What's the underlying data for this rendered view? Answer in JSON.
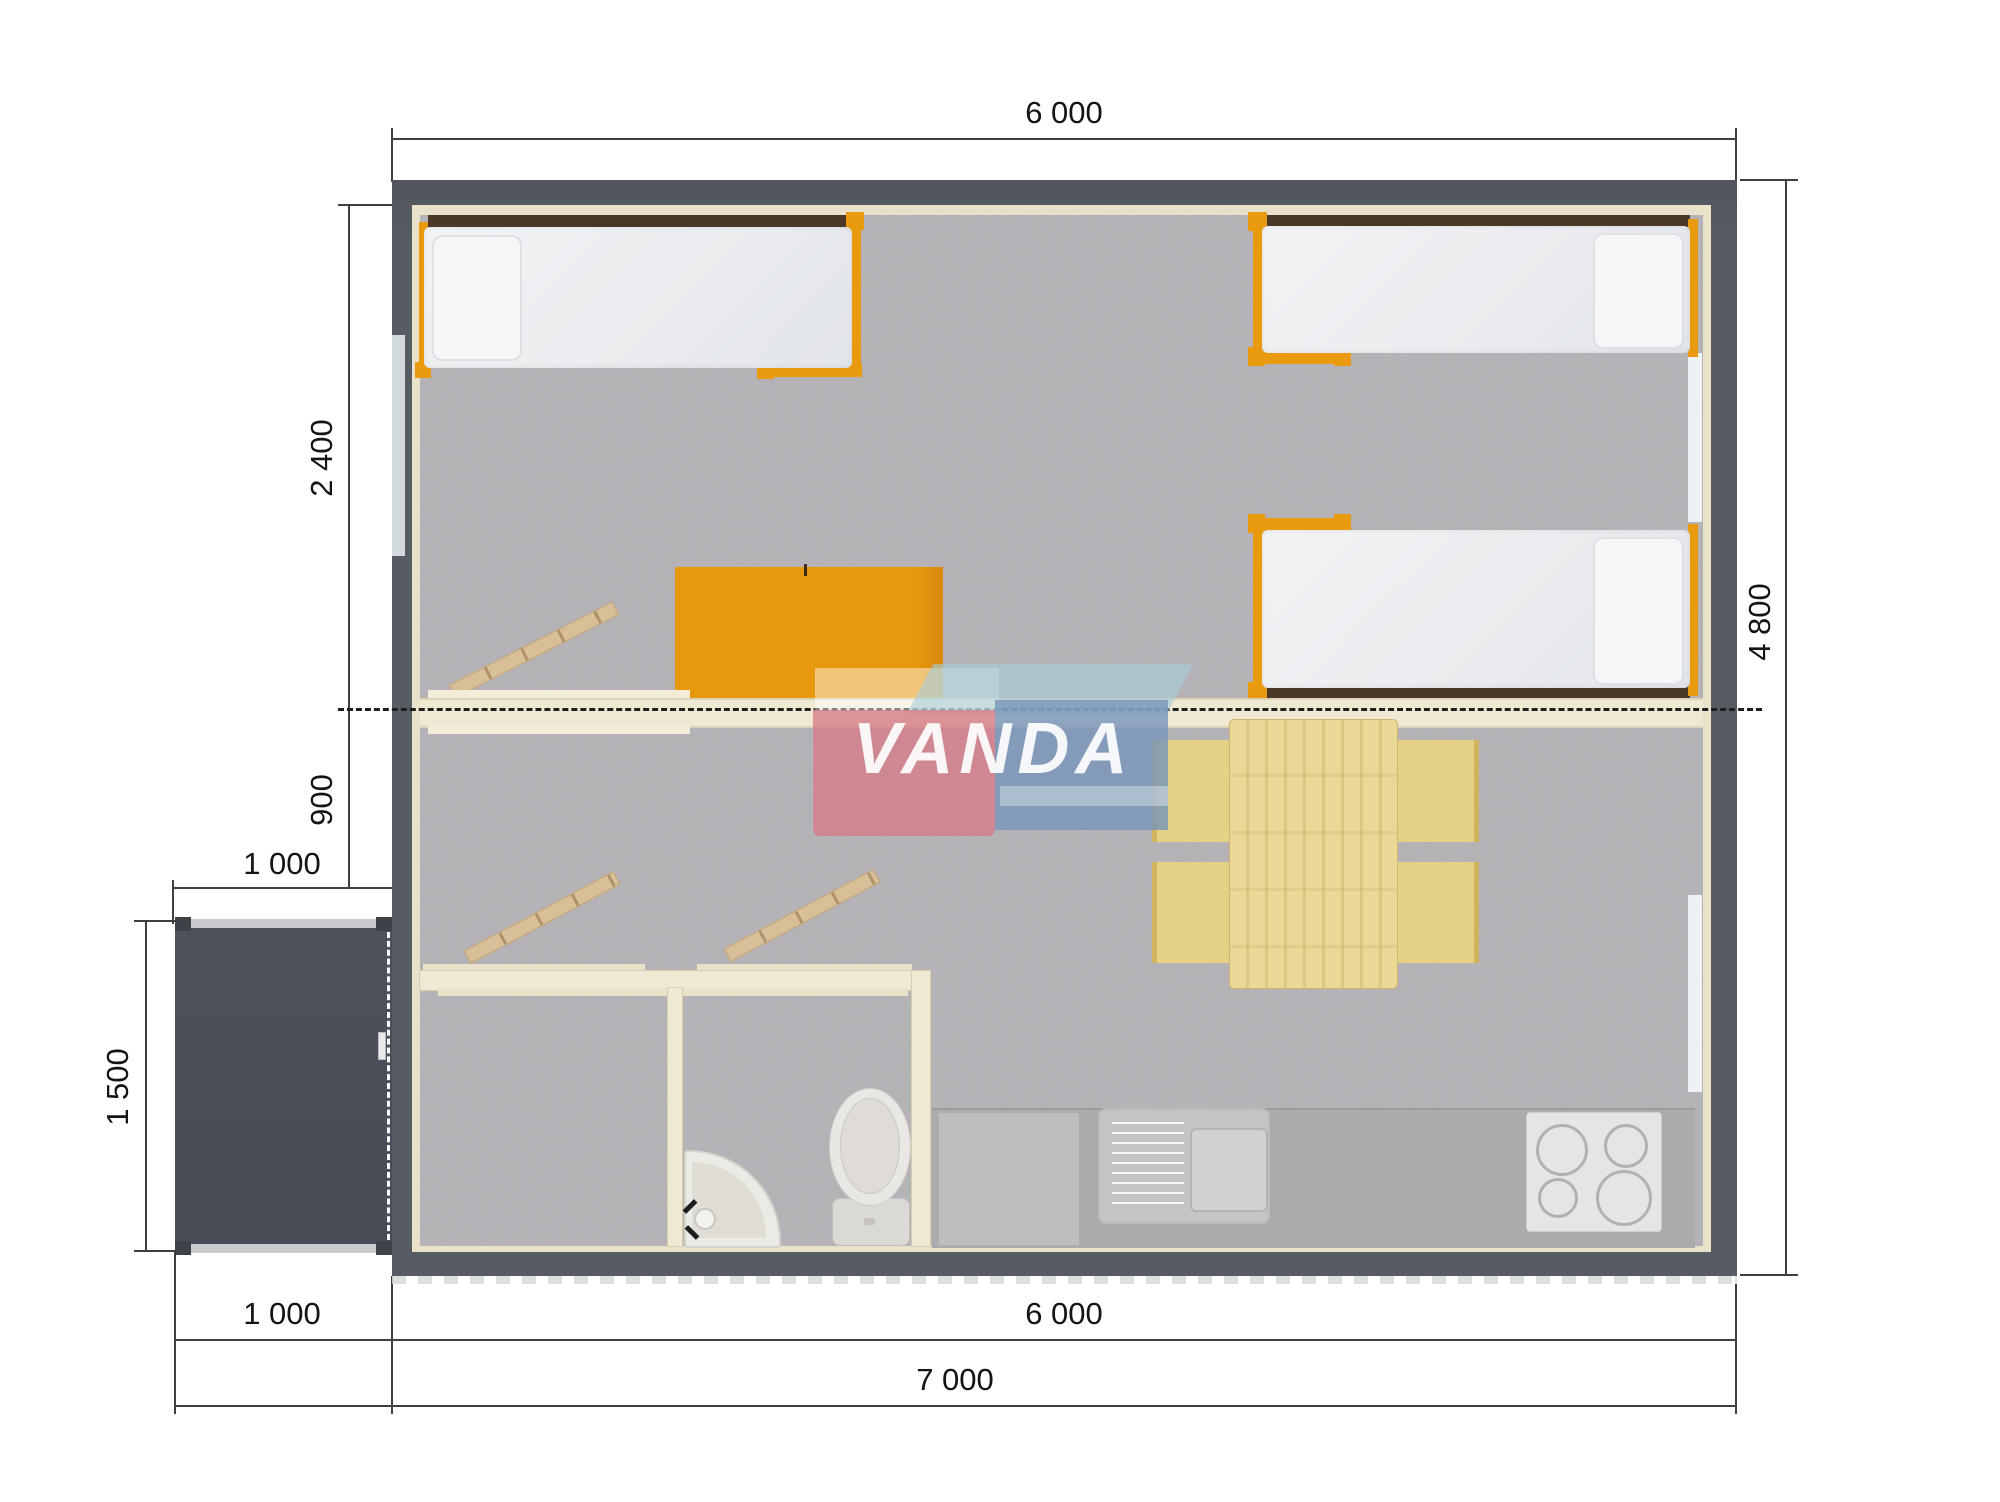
{
  "title": "Modular house floor plan",
  "watermark": {
    "text": "VANDA"
  },
  "dimensions": {
    "top_width": "6 000",
    "bedroom_depth": "2 400",
    "hall_depth": "900",
    "porch_width_top": "1 000",
    "porch_depth": "1 500",
    "right_height": "4 800",
    "bottom_porch_width": "1 000",
    "bottom_main_width": "6 000",
    "bottom_total_width": "7 000"
  },
  "colors": {
    "wall_dark": "#575C64",
    "porch_dark": "#4A4E58",
    "carpet_gray": "#B4B2B6",
    "wood_beige": "#EFE9D3",
    "accent_orange": "#EA9A0F",
    "shelf_brown": "#4C3826",
    "table_pine": "#EAD896",
    "chair_yellow": "#E6D287",
    "kitchen_gray": "#A9ABAD",
    "logo_pink": "#D67D8A",
    "logo_blue": "#7896BD",
    "logo_teal": "#A8CDD9"
  }
}
